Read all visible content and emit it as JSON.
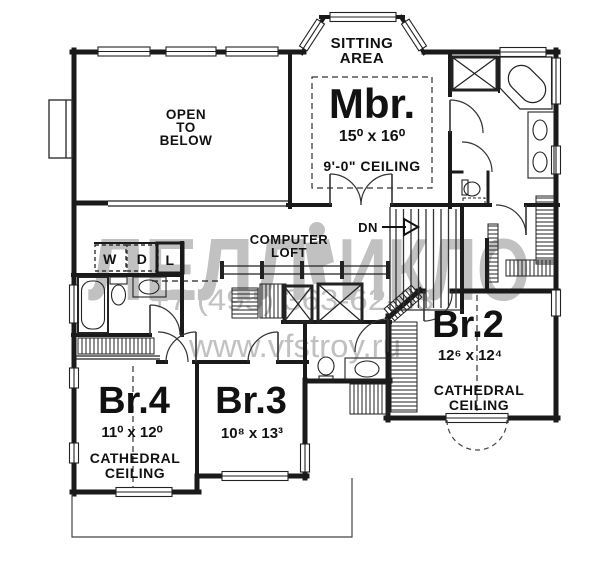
{
  "document": {
    "type": "second-floor plan drawing"
  },
  "rooms": {
    "sitting_area": {
      "line1": "SITTING",
      "line2": "AREA"
    },
    "open_to_below": {
      "line1": "OPEN",
      "line2": "TO",
      "line3": "BELOW"
    },
    "master_bedroom": {
      "name": "Mbr.",
      "dims": "15⁰ x 16⁰",
      "ceiling": "9'-0\" CEILING"
    },
    "computer_loft": {
      "line1": "COMPUTER",
      "line2": "LOFT"
    },
    "bedroom2": {
      "name": "Br.2",
      "dims": "12⁶ x 12⁴",
      "ceiling_line1": "CATHEDRAL",
      "ceiling_line2": "CEILING"
    },
    "bedroom3": {
      "name": "Br.3",
      "dims": "10⁸ x 13³"
    },
    "bedroom4": {
      "name": "Br.4",
      "dims": "11⁰ x 12⁰",
      "ceiling_line1": "CATHEDRAL",
      "ceiling_line2": "CEILING"
    }
  },
  "labels": {
    "stairs_down": "DN",
    "washer": "W",
    "dryer": "D",
    "linen": "L"
  },
  "watermark": {
    "logo_left": "ЛЕЛЛ",
    "logo_right": "ИКЛО",
    "phone": "+7 (495) 363-62-63",
    "website": "www.vfstroy.ru"
  },
  "colors": {
    "wall": "#1a1a1a",
    "watermark_gray": "#9c9c9c",
    "background": "#ffffff"
  }
}
